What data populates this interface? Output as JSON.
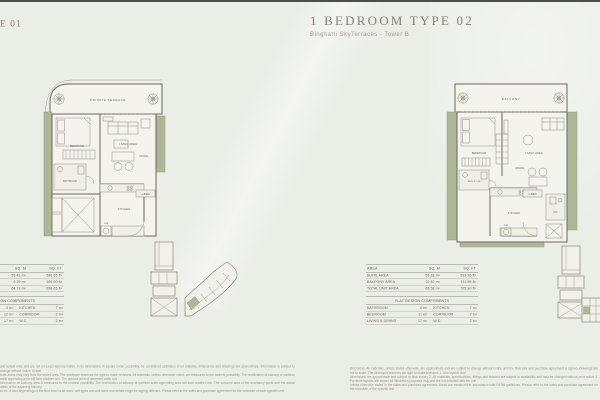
{
  "page": {
    "background": "#ebede7",
    "top_rule_color": "#4d4d49",
    "accent_green": "#adb798"
  },
  "left_unit": {
    "title_fragment": "E 01",
    "plan": {
      "terrace": "PRIVATE TERRACE",
      "bedroom": "BEDROOM",
      "bathroom": "BATHROOM",
      "living": "LIVING AREA",
      "dining": "DINING",
      "kitchen": "KITCHEN",
      "washer": "W/M",
      "unit_tag": "1-BED"
    },
    "table": {
      "col_area": "",
      "col_sqm": "SQ. M",
      "col_sqft": "SQ. FT",
      "rows": [
        {
          "name": "SUITE AREA",
          "sqm": "55.43 m²",
          "sqft": "596.65 ft²"
        },
        {
          "name": "TERRACE AREA",
          "sqm": "9.29 m²",
          "sqft": "100.00 ft²"
        },
        {
          "name": "TOTAL UNIT AREA",
          "sqm": "64.72 m²",
          "sqft": "696.65 ft²"
        }
      ],
      "components_title": "FLAT DESIGN COMPONENTS",
      "components": [
        {
          "n1": "BATHROOM",
          "v1": "4 m²",
          "n2": "KITCHEN",
          "v2": "7 m²"
        },
        {
          "n1": "BEDROOM",
          "v1": "12 m²",
          "n2": "CORRIDOR",
          "v2": "2 m²"
        },
        {
          "n1": "LIVING & DINING",
          "v1": "17 m²",
          "n2": "W.C.",
          "v2": "2 m²"
        }
      ]
    }
  },
  "right_unit": {
    "title": "1 BEDROOM TYPE 02",
    "subtitle": "Binghatti SkyTerraces - Tower B",
    "plan": {
      "balcony": "BALCONY",
      "bedroom": "BEDROOM",
      "bathroom": "BATH ROOM",
      "living": "LIVING AREA",
      "dining": "DINING",
      "kitchen": "KITCHEN",
      "washer": "W/M",
      "wc": "WC",
      "unit_tag": "1-BED"
    },
    "table": {
      "col_area": "AREA",
      "col_sqm": "SQ. M",
      "col_sqft": "SQ. FT",
      "rows": [
        {
          "name": "SUITE AREA",
          "sqm": "55.18 m²",
          "sqft": "593.95 ft²"
        },
        {
          "name": "BALCONY AREA",
          "sqm": "10.40 m²",
          "sqft": "111.95 ft²"
        },
        {
          "name": "TOTAL UNIT AREA",
          "sqm": "65.58 m²",
          "sqft": "705.90 ft²"
        }
      ],
      "components_title": "FLAT DESIGN COMPONENTS",
      "components": [
        {
          "n1": "BATHROOM",
          "v1": "4 m²",
          "n2": "KITCHEN",
          "v2": "7 m²"
        },
        {
          "n1": "BEDROOM",
          "v1": "11 m²",
          "n2": "CORRIDOR",
          "v2": "2 m²"
        },
        {
          "n1": "LIVING & DINING",
          "v1": "17 m²",
          "n2": "W.C.",
          "v2": "2 m²"
        }
      ]
    }
  },
  "disclaimer": {
    "left_lines": [
      "and actual units and are not an exact representation. In its dimensions in square meter possibility, be considered estimates if not material, dimensions and drawings are approximate. Information is subject to change without notice. Actual",
      "suite areas may vary from the stated area. The developer reserves the right to make revisions. All materials, unless otherwise noted, are measured to the nearest possibility. The rectification of balcony or partition walls appending area will form another unit. The outdoor area of abutment walls and",
      "information on balcony area is measured to the nearest possibility. The rectification of balcony or partition walls appending area will form another unit. The outcome area of the accessory guest and the actual areas of the adjoining balcony",
      "to etc. It also depending on the floor level to be used, unit types and unit sizes and details might be slightly different. Please refer to the sales and purchase agreement for the schedule of each specific unit."
    ],
    "right_lines": [
      "Disclaimer: All materials, unless stated otherwise, are approximate and are subject to change without notice until the final sale and purchase agreement is signed. Drawings are not to scale. The developer reserves the right to make revisions 1. Unit layouts and",
      "dimensions are approximate and subject to final survey 2. All materials, specifications, fittings and finishes are subject to availability and may be changed without prior notice 3. Furniture layouts are shown for illustration purposes only and are not included with the unit",
      "unless otherwise stated in the sales and purchase agreement. Areas are measured in accordance with RERA guidelines. Please refer to the sales and purchase agreement for the schedule of the specific unit."
    ]
  }
}
